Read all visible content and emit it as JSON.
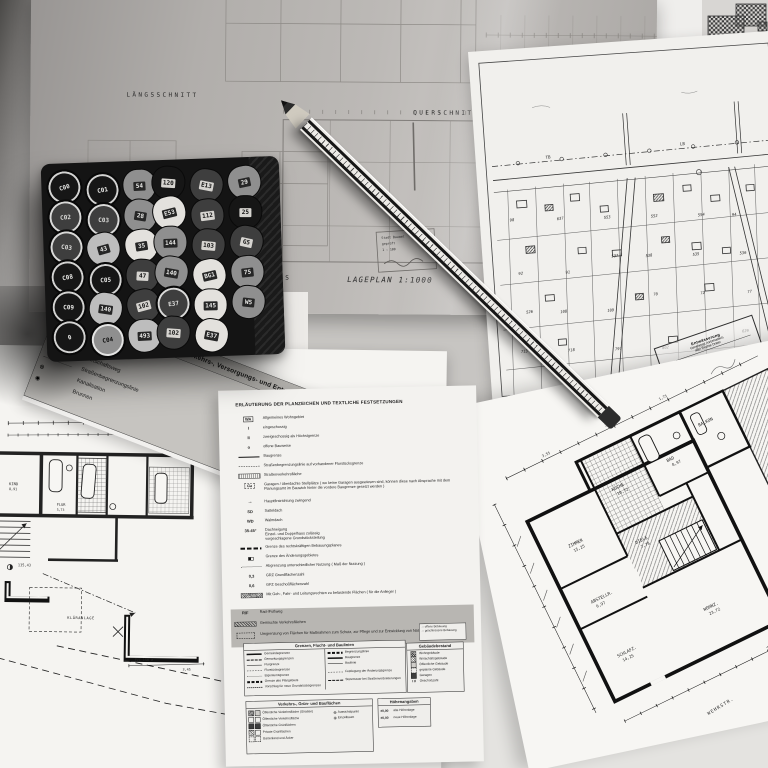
{
  "top_sheet": {
    "label_laengsschnitt": "LÄNGSSCHNITT",
    "label_querschnitt": "QUERSCHNITT",
    "label_grundriss": "GRUNDRISS",
    "label_lageplan": "LAGEPLAN 1:1000",
    "stamp_line1": "Stadt Bauamt",
    "stamp_line2": "geprüft",
    "stamp_line3": "1 : 100"
  },
  "marker_box": {
    "caps": [
      {
        "label": "C00",
        "tone": "black",
        "shape": "round"
      },
      {
        "label": "C01",
        "tone": "black",
        "shape": "round"
      },
      {
        "label": "54",
        "tone": "gray",
        "shape": "tri"
      },
      {
        "label": "120",
        "tone": "black",
        "shape": "tri"
      },
      {
        "label": "E13",
        "tone": "dark",
        "shape": "tri"
      },
      {
        "label": "29",
        "tone": "gray",
        "shape": "tri"
      },
      {
        "label": "C02",
        "tone": "dark",
        "shape": "round"
      },
      {
        "label": "C03",
        "tone": "dark",
        "shape": "round"
      },
      {
        "label": "28",
        "tone": "gray",
        "shape": "tri"
      },
      {
        "label": "E53",
        "tone": "white",
        "shape": "tri"
      },
      {
        "label": "112",
        "tone": "dark",
        "shape": "tri"
      },
      {
        "label": "25",
        "tone": "black",
        "shape": "tri"
      },
      {
        "label": "C03",
        "tone": "dark",
        "shape": "round"
      },
      {
        "label": "43",
        "tone": "light",
        "shape": "tri"
      },
      {
        "label": "35",
        "tone": "white",
        "shape": "tri"
      },
      {
        "label": "144",
        "tone": "gray",
        "shape": "tri"
      },
      {
        "label": "103",
        "tone": "dark",
        "shape": "tri"
      },
      {
        "label": "G5",
        "tone": "dark",
        "shape": "tri"
      },
      {
        "label": "C08",
        "tone": "black",
        "shape": "round"
      },
      {
        "label": "C05",
        "tone": "black",
        "shape": "round"
      },
      {
        "label": "47",
        "tone": "dark",
        "shape": "tri"
      },
      {
        "label": "140",
        "tone": "gray",
        "shape": "tri"
      },
      {
        "label": "BG1",
        "tone": "white",
        "shape": "tri"
      },
      {
        "label": "75",
        "tone": "gray",
        "shape": "tri"
      },
      {
        "label": "C09",
        "tone": "black",
        "shape": "round"
      },
      {
        "label": "140",
        "tone": "light",
        "shape": "tri"
      },
      {
        "label": "102",
        "tone": "dark",
        "shape": "tri"
      },
      {
        "label": "E37",
        "tone": "dark",
        "shape": "round"
      },
      {
        "label": "145",
        "tone": "white",
        "shape": "tri"
      },
      {
        "label": "W5",
        "tone": "gray",
        "shape": "tri"
      },
      {
        "label": "0",
        "tone": "black",
        "shape": "round"
      },
      {
        "label": "C04",
        "tone": "gray",
        "shape": "round"
      },
      {
        "label": "493",
        "tone": "light",
        "shape": "tri"
      },
      {
        "label": "102",
        "tone": "dark",
        "shape": "tri"
      },
      {
        "label": "E37",
        "tone": "white",
        "shape": "tri"
      }
    ]
  },
  "site_plan": {
    "street_label_left": "TB",
    "street_label_right": "LB",
    "parcel_numbers": [
      "98",
      "637",
      "553",
      "552",
      "554",
      "94",
      "92",
      "91",
      "537",
      "538",
      "535",
      "536",
      "526",
      "108",
      "109",
      "70",
      "72",
      "77",
      "713",
      "718",
      "797",
      "802",
      "820",
      "629"
    ],
    "stamp": {
      "line1": "Entwässerung",
      "line2": "Genehmigt vorbehaltlich",
      "line3": "aller Rechte Dritter"
    }
  },
  "legend_sheet": {
    "title": "ERLÄUTERUNG DER PLANZEICHEN UND TEXTLICHE FESTSETZUNGEN",
    "items": [
      {
        "sym": "WA",
        "symtype": "wa",
        "label": "Allgemeines Wohngebiet"
      },
      {
        "sym": "I",
        "symtype": "txt",
        "label": "eingeschossig"
      },
      {
        "sym": "II",
        "symtype": "txt",
        "label": "zweigeschossig als Höchstgrenze"
      },
      {
        "sym": "o",
        "symtype": "txt",
        "label": "offene Bauweise"
      },
      {
        "sym": "",
        "symtype": "line-solid",
        "label": "Baugrenze"
      },
      {
        "sym": "",
        "symtype": "line-dashdot",
        "label": "Straßenbegrenzungslinie auf vorhandener Flurstücksgrenze"
      },
      {
        "sym": "",
        "symtype": "bar-hatch",
        "label": "Straßenverkehrsfläche"
      },
      {
        "sym": "Ga",
        "symtype": "box-dash",
        "label": "Garagen / überdachte Stellplätze ( wo keine Garagen ausgewiesen sind, können diese nach Absprache mit dem Planungsamt im Bauwich hinter die vordere Baugrenze gesetzt werden )"
      },
      {
        "sym": "→",
        "symtype": "arrow",
        "label": "Hauptfirstrichtung zwingend"
      },
      {
        "sym": "SD",
        "symtype": "txt",
        "label": "Satteldach"
      },
      {
        "sym": "WD",
        "symtype": "txt",
        "label": "Walmdach"
      },
      {
        "sym": "35-45°",
        "symtype": "txt",
        "label": "Dachneigung\nEinzel- und Doppelhaus zulässig\nvorgeschlagene Grundstücksteilung"
      },
      {
        "sym": "",
        "symtype": "line-thickdash",
        "label": "Grenze des rechtskräftigen Bebauungsplanes"
      },
      {
        "sym": "",
        "symtype": "line-squares",
        "label": "Grenze des Änderungsgebietes"
      },
      {
        "sym": "",
        "symtype": "line-dashdot2",
        "label": "Abgrenzung unterschiedlicher Nutzung ( Maß der Nutzung )"
      },
      {
        "sym": "0,3",
        "symtype": "txt",
        "label": "GRZ  Grundflächenzahl"
      },
      {
        "sym": "0,6",
        "symtype": "txt",
        "label": "GFZ  Geschoßflächenzahl"
      },
      {
        "sym": "",
        "symtype": "hatch-sq",
        "label": "Mit Geh-, Fahr- und Leitungsrechten zu belastende Flächen ( für die Anlieger )"
      }
    ],
    "shaded_items": [
      {
        "sym": "R/F",
        "symtype": "txt",
        "label": "Rad-/Fußweg"
      },
      {
        "sym": "",
        "symtype": "hatch-diag",
        "label": "Gemischte Verkehrsflächen"
      },
      {
        "sym": "",
        "symtype": "box-dash2",
        "label": "Umgrenzung von Flächen für Maßnahmen zum Schutz, zur Pflege und zur Entwicklung von Natur und Landschaft"
      }
    ],
    "mini_box": {
      "rows": [
        "offene Bebauung",
        "geschlossene Bebauung"
      ]
    },
    "tables": {
      "grenzen": {
        "title": "Grenzen, Flucht- und Baulinien",
        "left": [
          "Gemeindegrenzen",
          "Gemarkungsgrenzen",
          "Flurgrenze",
          "Flurstücksgrenzen",
          "Eigentumsgrenze",
          "Grenze des Plangebiets",
          "Vorschlag für neue Grundstücksgrenzen"
        ],
        "right": [
          "Begrenzungslinie",
          "Baugrenze",
          "Baulinie",
          "Festlegung der Änderungsgrenze",
          "Stützmauer bei Straßenverbreiterungen"
        ]
      },
      "gebaeude": {
        "title": "Gebäudebestand",
        "rows": [
          "Wohngebäude",
          "Wirtschaftsgebäude",
          "Öffentliche Gebäude",
          "geplante Gebäude",
          "Garagen",
          "Geschoßzahl"
        ]
      },
      "verkehr": {
        "title": "Verkehrs-, Grün- und Bauflächen",
        "rows": [
          "Öffentliche Verkehrsfläche (Straßen)",
          "Öffentliche Verkehrsfläche",
          "Öffentliche Grünflächen",
          "Private Grünflächen",
          "Gartenland und Äcker"
        ],
        "extra": [
          "Aussichtspunkt",
          "Einzelbaum"
        ]
      },
      "hoehen": {
        "title": "Höhenangaben",
        "rows": [
          {
            "sym": "±0,00",
            "label": "alte Höhenlage"
          },
          {
            "sym": "±0,00",
            "label": "neue Höhenlage"
          }
        ]
      }
    }
  },
  "slip": {
    "title": "Verkehrs-, Versorgungs- und Entwässerungsanlagen",
    "rows": [
      "Bundesstraße",
      "Kreisstraße",
      "Wirtschaftsweg",
      "Straßenbegrenzungslinie",
      "Kanalisation",
      "Brunnen"
    ]
  },
  "plan_right": {
    "title": "ERDGESCHOSS",
    "subtitle": "WOHNUNG  89,78 qm",
    "street": "WEHRSTR.",
    "firstline": "FIRSTL.",
    "dims": [
      "3,55",
      "2,45",
      "1,75"
    ],
    "rooms": [
      {
        "name": "ZIMMER",
        "area": "15,25"
      },
      {
        "name": "KÜCHE",
        "area": "10,72"
      },
      {
        "name": "BAD",
        "area": "8,97"
      },
      {
        "name": "BALKON",
        "area": ""
      },
      {
        "name": "ABSTELLR.",
        "area": "6,97"
      },
      {
        "name": "DIELE",
        "area": "7,78"
      },
      {
        "name": "WOHNZ.",
        "area": "23,72"
      },
      {
        "name": "SCHLAFZ.",
        "area": "14,25"
      }
    ]
  },
  "plan_left": {
    "room": "KIND",
    "room_area": "8,91",
    "flur": "FLUR",
    "flur_area": "5,73",
    "dim_total": "11,44",
    "level": "135,43",
    "klaeranlage": "KLÄRANLAGE",
    "pipe": "PVC 150 ⌀",
    "pipe_len": "3,45"
  }
}
